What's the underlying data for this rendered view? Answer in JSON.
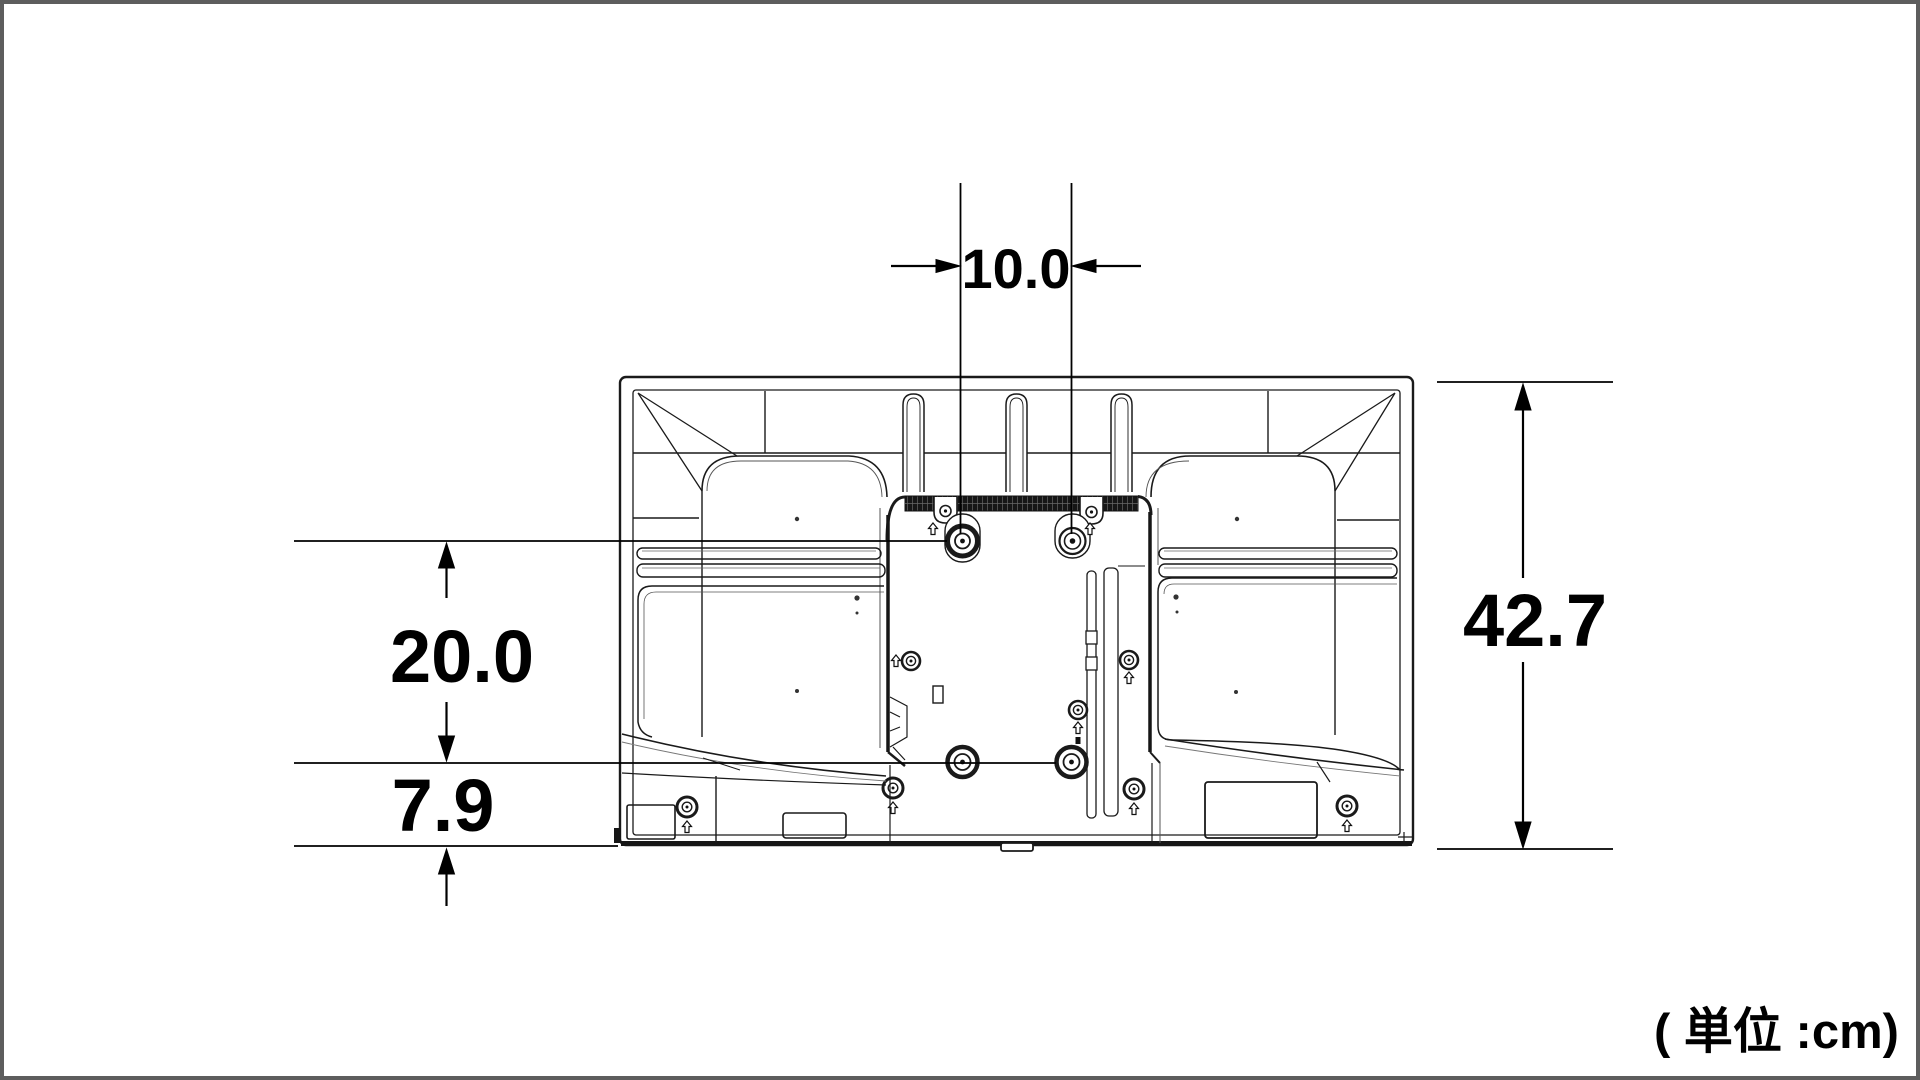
{
  "diagram": {
    "unit_note": "( 単位 :cm)",
    "dimensions": {
      "vesa_horizontal_spacing": "10.0",
      "vesa_vertical_spacing": "20.0",
      "bottom_offset": "7.9",
      "overall_height": "42.7"
    },
    "colors": {
      "background": "#ffffff",
      "page_border": "#5d5d5d",
      "line_art": "#1a1a1a",
      "dimension": "#000000",
      "hatch_fill": "#161616"
    }
  }
}
